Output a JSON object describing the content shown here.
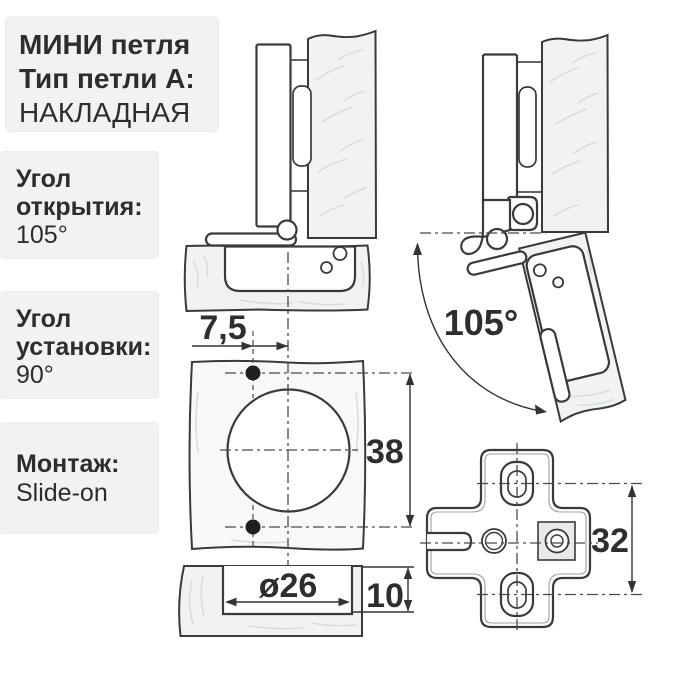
{
  "info_boxes": {
    "title": {
      "line1": "МИНИ петля",
      "line2": "Тип петли А:",
      "line3": "НАКЛАДНАЯ"
    },
    "opening_angle": {
      "line1": "Угол",
      "line2": "открытия:",
      "value": "105°"
    },
    "installation_angle": {
      "line1": "Угол",
      "line2": "установки:",
      "value": "90°"
    },
    "mounting": {
      "label": "Монтаж:",
      "value": "Slide-on"
    }
  },
  "drawings": {
    "open_hinge": {
      "angle_label": "105°"
    },
    "drilling_pattern": {
      "cup_offset": "7,5",
      "hole_spacing": "38"
    },
    "cup_cross_section": {
      "cup_diameter": "ø26",
      "cup_depth": "10"
    },
    "mounting_plate": {
      "hole_spacing": "32"
    }
  },
  "colors": {
    "background": "#ffffff",
    "box_background": "#f1f2f2",
    "line": "#3a3a3a",
    "wood_fill": "#f1f3f3",
    "text": "#2d2d2d"
  }
}
